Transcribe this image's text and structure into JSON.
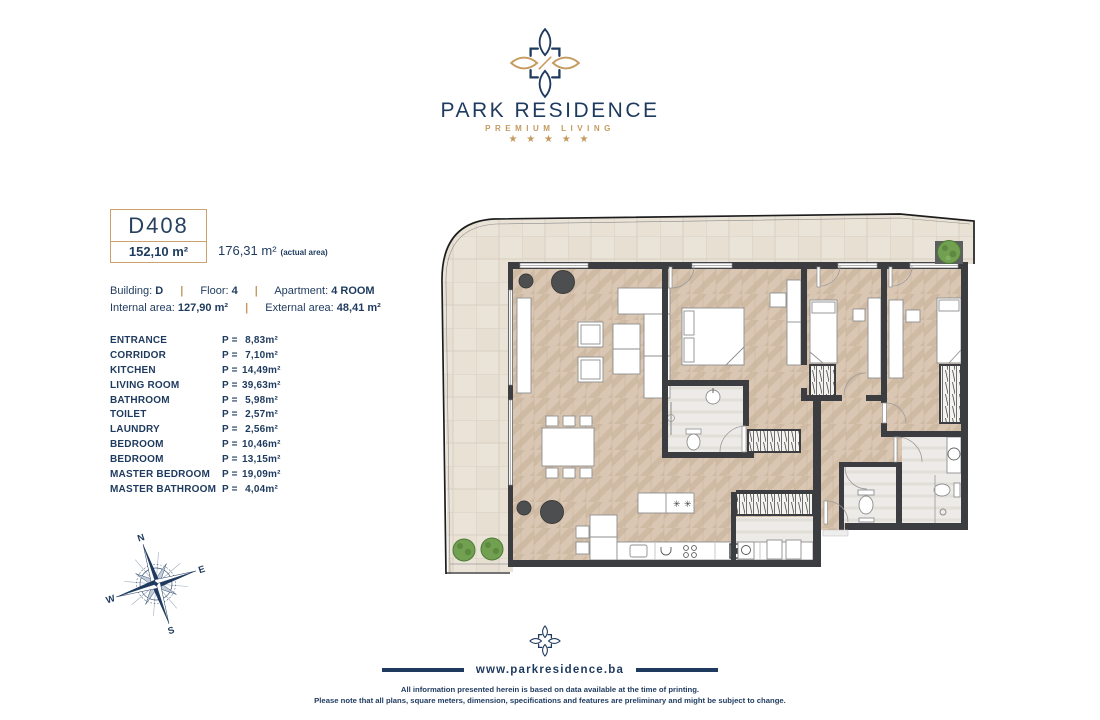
{
  "logo": {
    "title": "PARK RESIDENCE",
    "subtitle": "PREMIUM LIVING",
    "stars": "★ ★ ★ ★ ★"
  },
  "unit": {
    "code": "D408",
    "area": "152,10 m²",
    "actual_area": "176,31 m²",
    "actual_area_note": "(actual area)"
  },
  "info": {
    "separator": "|",
    "building_label": "Building:",
    "building_value": "D",
    "floor_label": "Floor:",
    "floor_value": "4",
    "apartment_label": "Apartment:",
    "apartment_value": "4 ROOM",
    "internal_label": "Internal area:",
    "internal_value": "127,90 m²",
    "external_label": "External area:",
    "external_value": "48,41 m²"
  },
  "rooms": [
    {
      "name": "ENTRANCE",
      "eq": "P =",
      "value": "8,83m²"
    },
    {
      "name": "CORRIDOR",
      "eq": "P =",
      "value": "7,10m²"
    },
    {
      "name": "KITCHEN",
      "eq": "P =",
      "value": "14,49m²"
    },
    {
      "name": "LIVING ROOM",
      "eq": "P =",
      "value": "39,63m²"
    },
    {
      "name": "BATHROOM",
      "eq": "P =",
      "value": "5,98m²"
    },
    {
      "name": "TOILET",
      "eq": "P =",
      "value": "2,57m²"
    },
    {
      "name": "LAUNDRY",
      "eq": "P =",
      "value": "2,56m²"
    },
    {
      "name": "BEDROOM",
      "eq": "P =",
      "value": "10,46m²"
    },
    {
      "name": "BEDROOM",
      "eq": "P =",
      "value": "13,15m²"
    },
    {
      "name": "MASTER BEDROOM",
      "eq": "P =",
      "value": "19,09m²"
    },
    {
      "name": "MASTER BATHROOM",
      "eq": "P =",
      "value": "4,04m²"
    }
  ],
  "compass": {
    "north": "N",
    "east": "E",
    "south": "S",
    "west": "W"
  },
  "footer": {
    "website": "www.parkresidence.ba",
    "disclaimer_line1": "All information presented herein is based on data available at the time of printing.",
    "disclaimer_line2": "Please note that all plans, square meters, dimension, specifications and features are preliminary and might be subject to change."
  },
  "colors": {
    "navy": "#1e3a5e",
    "gold": "#c49a5f",
    "wall": "#3b3d40",
    "wood_floor": "#dac7b3",
    "terrace_tile": "#eae3d7",
    "plant_green": "#6fa04c"
  }
}
